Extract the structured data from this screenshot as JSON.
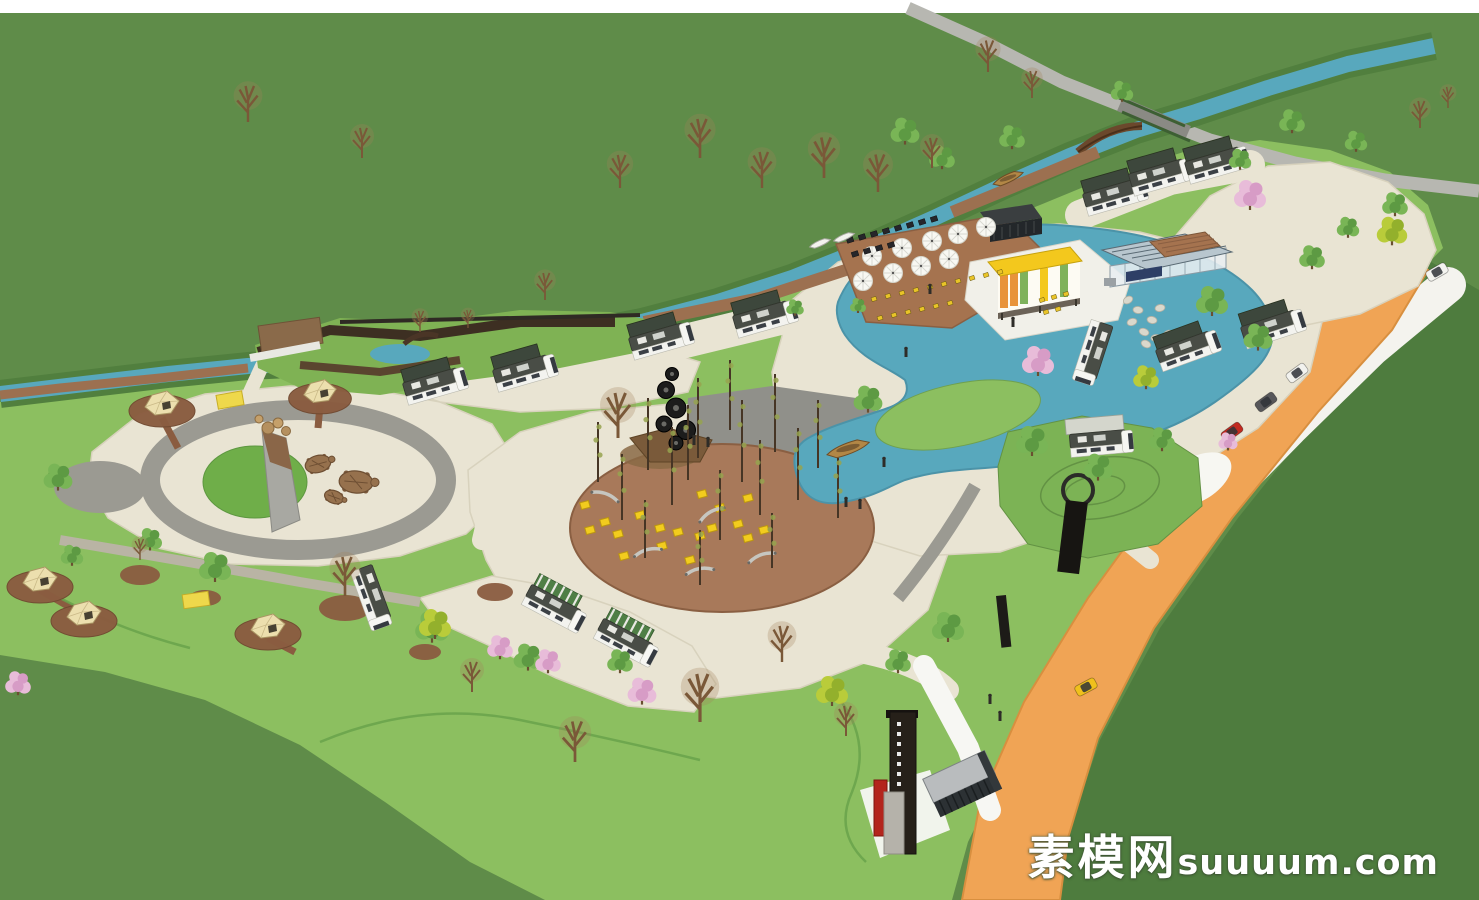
{
  "watermark": {
    "cjk": "素模网",
    "latin": "suuuum.com"
  },
  "palette": {
    "sky_strip": "#ffffff",
    "outer_grass": "#5f8c49",
    "outer_grass_dark": "#4e7c3e",
    "site_grass": "#8cbf60",
    "marsh_green": "#7fb254",
    "mound_green": "#7cb355",
    "water": "#58a8bd",
    "water_edge": "#4b93a8",
    "cream_path": "#e9e4d3",
    "gray_path": "#9b9a92",
    "gray_plaza": "#90908a",
    "road_gray": "#b7b7b1",
    "white_road": "#f4f3ee",
    "orange_road": "#f0a455",
    "brick": "#a5734f",
    "grove_brick": "#a8795a",
    "pad_brown": "#8a5c40",
    "boardwalk_dark": "#3d2f22",
    "bridge_wood": "#6b482c",
    "building_yellow": "#f3c81d",
    "container_dark": "#2c3134",
    "tower_dark": "#262019",
    "red_accent": "#b3251d",
    "rv_body": "#f3f3ef",
    "rv_roof": "#494d46",
    "awning_dark": "#3d473c",
    "awning_green": "#4f7f46",
    "canopy_gray": "#d4d6cc",
    "tent_fill": "#ecdfae",
    "cube_yellow": "#f2cc1e",
    "chair_yellow": "#e9c428",
    "table_dark": "#26262a",
    "bench_silver": "#c6c6c0",
    "stone_gray": "#dad8cc",
    "boat_wood": "#b28746",
    "boat_white": "#f3f3ee",
    "umbrella_white": "#f8f8f3",
    "turtle_brown": "#96714d",
    "mat_yellow": "#eed84b",
    "tree_green_1": "#5d9a43",
    "tree_green_2": "#79b556",
    "tree_yellow_1": "#93b02c",
    "tree_yellow_2": "#b9cc3a",
    "tree_pink_1": "#d79cc6",
    "tree_pink_2": "#e8bcd9",
    "bare_trunk": "#7a5838",
    "person_dark": "#2e2c28"
  },
  "scene": {
    "trees_green": [
      [
        58,
        478,
        0.9
      ],
      [
        150,
        540,
        0.75
      ],
      [
        215,
        568,
        1.0
      ],
      [
        72,
        556,
        0.7
      ],
      [
        432,
        628,
        1.05
      ],
      [
        528,
        658,
        0.9
      ],
      [
        620,
        662,
        0.8
      ],
      [
        948,
        628,
        1.0
      ],
      [
        898,
        662,
        0.8
      ],
      [
        1032,
        442,
        1.0
      ],
      [
        1098,
        468,
        0.9
      ],
      [
        1162,
        440,
        0.8
      ],
      [
        1212,
        302,
        1.0
      ],
      [
        1258,
        338,
        0.9
      ],
      [
        1312,
        258,
        0.8
      ],
      [
        1348,
        228,
        0.7
      ],
      [
        905,
        132,
        0.9
      ],
      [
        942,
        158,
        0.8
      ],
      [
        1012,
        138,
        0.8
      ],
      [
        1122,
        92,
        0.7
      ],
      [
        1292,
        122,
        0.8
      ],
      [
        1356,
        142,
        0.7
      ],
      [
        868,
        400,
        0.9
      ],
      [
        795,
        308,
        0.55
      ],
      [
        858,
        306,
        0.5
      ],
      [
        1240,
        160,
        0.7
      ],
      [
        1395,
        205,
        0.8
      ],
      [
        755,
        490,
        0.0
      ]
    ],
    "trees_yellow": [
      [
        1392,
        232,
        0.95
      ],
      [
        1146,
        378,
        0.8
      ],
      [
        435,
        625,
        1.0
      ],
      [
        832,
        692,
        1.0
      ]
    ],
    "trees_pink": [
      [
        1250,
        196,
        1.0
      ],
      [
        1038,
        362,
        1.0
      ],
      [
        642,
        692,
        0.9
      ],
      [
        548,
        662,
        0.8
      ],
      [
        1228,
        442,
        0.6
      ],
      [
        18,
        684,
        0.8
      ],
      [
        500,
        648,
        0.8
      ]
    ],
    "trees_bare": [
      [
        248,
        122,
        1.2
      ],
      [
        362,
        158,
        1.0
      ],
      [
        545,
        300,
        0.9
      ],
      [
        620,
        188,
        1.1
      ],
      [
        700,
        158,
        1.3
      ],
      [
        762,
        188,
        1.2
      ],
      [
        824,
        178,
        1.35
      ],
      [
        878,
        192,
        1.25
      ],
      [
        932,
        168,
        1.0
      ],
      [
        988,
        72,
        1.05
      ],
      [
        1032,
        98,
        0.9
      ],
      [
        618,
        438,
        1.5
      ],
      [
        700,
        722,
        1.6
      ],
      [
        782,
        662,
        1.2
      ],
      [
        846,
        736,
        1.0
      ],
      [
        575,
        762,
        1.35
      ],
      [
        472,
        692,
        1.0
      ],
      [
        345,
        596,
        1.3
      ],
      [
        140,
        560,
        0.7
      ],
      [
        1420,
        128,
        0.9
      ],
      [
        1448,
        108,
        0.7
      ],
      [
        420,
        332,
        0.7
      ],
      [
        468,
        328,
        0.6
      ]
    ],
    "grove_poles": [
      [
        598,
        482,
        60
      ],
      [
        622,
        520,
        66
      ],
      [
        648,
        470,
        72
      ],
      [
        672,
        505,
        78
      ],
      [
        698,
        458,
        80
      ],
      [
        720,
        540,
        70
      ],
      [
        742,
        482,
        82
      ],
      [
        760,
        515,
        75
      ],
      [
        775,
        452,
        78
      ],
      [
        798,
        500,
        72
      ],
      [
        818,
        468,
        68
      ],
      [
        838,
        518,
        60
      ],
      [
        700,
        585,
        55
      ],
      [
        645,
        558,
        58
      ],
      [
        772,
        568,
        55
      ],
      [
        730,
        430,
        70
      ],
      [
        688,
        480,
        75
      ]
    ],
    "cubes": [
      [
        585,
        505
      ],
      [
        605,
        522
      ],
      [
        618,
        534
      ],
      [
        640,
        515
      ],
      [
        660,
        528
      ],
      [
        678,
        532
      ],
      [
        700,
        536
      ],
      [
        712,
        528
      ],
      [
        738,
        524
      ],
      [
        748,
        538
      ],
      [
        662,
        546
      ],
      [
        624,
        556
      ],
      [
        590,
        530
      ],
      [
        702,
        494
      ],
      [
        720,
        508
      ],
      [
        748,
        498
      ],
      [
        764,
        530
      ],
      [
        690,
        560
      ]
    ],
    "benches": [
      [
        648,
        553,
        -15
      ],
      [
        700,
        572,
        -10
      ],
      [
        762,
        558,
        -20
      ],
      [
        712,
        515,
        -30
      ],
      [
        605,
        497,
        20
      ]
    ],
    "umbrellas": [
      [
        872,
        256
      ],
      [
        902,
        248
      ],
      [
        932,
        241
      ],
      [
        958,
        234
      ],
      [
        986,
        227
      ],
      [
        863,
        281
      ],
      [
        893,
        273
      ],
      [
        921,
        266
      ],
      [
        949,
        259
      ]
    ],
    "chairs_yellow": [
      [
        860,
        302
      ],
      [
        874,
        299
      ],
      [
        888,
        296
      ],
      [
        902,
        293
      ],
      [
        916,
        290
      ],
      [
        930,
        287
      ],
      [
        944,
        284
      ],
      [
        958,
        281
      ],
      [
        972,
        278
      ],
      [
        986,
        275
      ],
      [
        1000,
        272
      ],
      [
        880,
        318
      ],
      [
        894,
        315
      ],
      [
        908,
        312
      ],
      [
        922,
        309
      ],
      [
        936,
        306
      ],
      [
        950,
        303
      ],
      [
        1042,
        300
      ],
      [
        1054,
        297
      ],
      [
        1066,
        294
      ],
      [
        1046,
        312
      ],
      [
        1058,
        309
      ]
    ],
    "tables_dark": [
      [
        850,
        240
      ],
      [
        862,
        237
      ],
      [
        874,
        234
      ],
      [
        886,
        231
      ],
      [
        898,
        228
      ],
      [
        910,
        225
      ],
      [
        922,
        222
      ],
      [
        934,
        219
      ],
      [
        855,
        254
      ],
      [
        867,
        251
      ],
      [
        879,
        248
      ],
      [
        891,
        245
      ]
    ],
    "stones": [
      [
        1128,
        300
      ],
      [
        1138,
        310
      ],
      [
        1132,
        322
      ],
      [
        1144,
        332
      ],
      [
        1156,
        338
      ],
      [
        1168,
        334
      ],
      [
        1152,
        320
      ],
      [
        1160,
        308
      ],
      [
        1146,
        344
      ],
      [
        1172,
        346
      ],
      [
        1180,
        338
      ]
    ],
    "turtles": [
      [
        318,
        464,
        1.0,
        -15
      ],
      [
        356,
        482,
        1.3,
        5
      ],
      [
        334,
        497,
        0.75,
        20
      ]
    ],
    "tents": [
      [
        162,
        404,
        1.0
      ],
      [
        320,
        392,
        0.95
      ],
      [
        40,
        580,
        1.0
      ],
      [
        84,
        614,
        1.0
      ],
      [
        268,
        627,
        1.0
      ]
    ],
    "mats": [
      [
        230,
        400,
        -10
      ],
      [
        196,
        600,
        -8
      ]
    ],
    "rvs": [
      [
        432,
        385,
        -16,
        0
      ],
      [
        522,
        372,
        -16,
        0
      ],
      [
        658,
        340,
        -16,
        0
      ],
      [
        762,
        318,
        -16,
        0
      ],
      [
        1112,
        196,
        -16,
        0
      ],
      [
        1158,
        176,
        -16,
        0
      ],
      [
        1214,
        164,
        -16,
        0
      ],
      [
        372,
        594,
        70,
        3
      ],
      [
        552,
        606,
        28,
        1
      ],
      [
        624,
        640,
        28,
        1
      ],
      [
        1185,
        350,
        -20,
        0
      ],
      [
        1095,
        350,
        108,
        3
      ],
      [
        1270,
        328,
        -18,
        0
      ],
      [
        1098,
        442,
        -5,
        2
      ]
    ],
    "cars": [
      [
        1232,
        432,
        -36,
        "#c22a20"
      ],
      [
        1266,
        402,
        -36,
        "#57575a"
      ],
      [
        1297,
        373,
        -36,
        "#f2f2ee"
      ],
      [
        1437,
        272,
        -30,
        "#f4f4f0"
      ],
      [
        1086,
        687,
        -28,
        "#f0c01c"
      ]
    ],
    "boats": [
      [
        848,
        448,
        -15,
        1.1,
        "wood"
      ],
      [
        1008,
        178,
        -20,
        0.8,
        "wood"
      ],
      [
        820,
        243,
        -18,
        0.55,
        "white"
      ],
      [
        844,
        237,
        -18,
        0.55,
        "white"
      ]
    ],
    "people": [
      [
        694,
        441
      ],
      [
        708,
        443
      ],
      [
        846,
        503
      ],
      [
        860,
        505
      ],
      [
        884,
        463
      ],
      [
        906,
        353
      ],
      [
        1013,
        323
      ],
      [
        990,
        700
      ],
      [
        1000,
        717
      ],
      [
        930,
        290
      ]
    ],
    "pads_brown": [
      [
        140,
        575,
        20,
        10
      ],
      [
        345,
        608,
        26,
        13
      ],
      [
        205,
        598,
        16,
        8
      ],
      [
        495,
        592,
        18,
        9
      ],
      [
        425,
        652,
        16,
        8
      ]
    ]
  }
}
